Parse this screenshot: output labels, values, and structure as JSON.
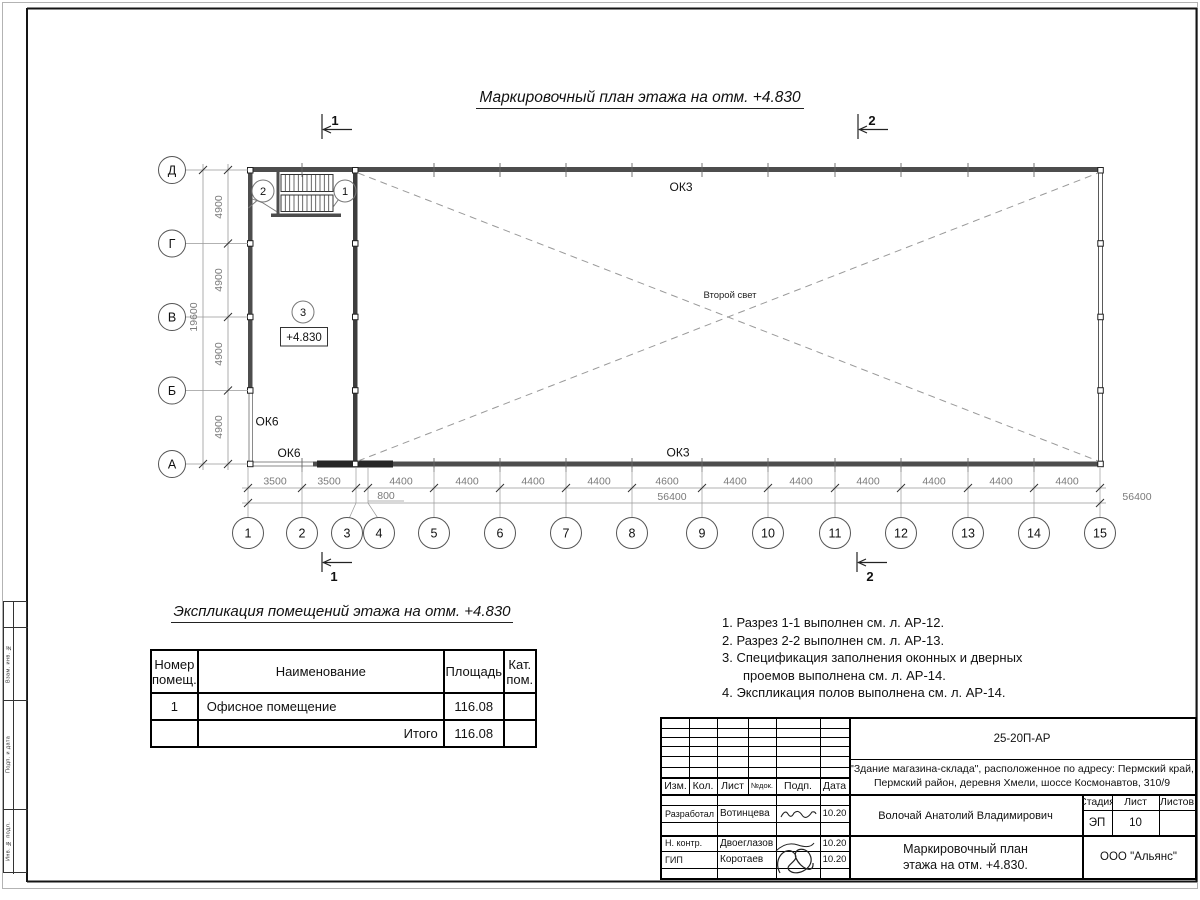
{
  "title": "Маркировочный план этажа на отм. +4.830",
  "plan": {
    "axes_h": [
      "1",
      "2",
      "3",
      "4",
      "5",
      "6",
      "7",
      "8",
      "9",
      "10",
      "11",
      "12",
      "13",
      "14",
      "15"
    ],
    "axes_v": [
      "Д",
      "Г",
      "В",
      "Б",
      "А"
    ],
    "dims_h": [
      "3500",
      "3500",
      "4400",
      "4400",
      "4400",
      "4400",
      "4600",
      "4400",
      "4400",
      "4400",
      "4400",
      "4400",
      "4400"
    ],
    "dim_small": "800",
    "dim_total_h": "56400",
    "dims_v": [
      "4900",
      "4900",
      "4900",
      "4900"
    ],
    "dim_total_v": "19600",
    "ok3": "ОК3",
    "ok6": "ОК6",
    "second_light": "Второй свет",
    "elevation": "+4.830",
    "markers": [
      "1",
      "2",
      "3"
    ],
    "sections": [
      "1",
      "2"
    ]
  },
  "explication": {
    "title": "Экспликация помещений этажа на отм. +4.830",
    "col_num_l1": "Номер",
    "col_num_l2": "помещ.",
    "col_name": "Наименование",
    "col_area": "Площадь",
    "col_cat_l1": "Кат.",
    "col_cat_l2": "пом.",
    "row1_num": "1",
    "row1_name": "Офисное помещение",
    "row1_area": "116.08",
    "total_label": "Итого",
    "total_value": "116.08"
  },
  "notes": {
    "lines": [
      "1. Разрез 1-1 выполнен см. л. АР-12.",
      "2. Разрез 2-2 выполнен см. л. АР-13.",
      "3. Спецификация заполнения оконных и дверных",
      "проемов выполнена см. л. АР-14.",
      "4. Экспликация полов выполнена см. л. АР-14."
    ]
  },
  "titleblock": {
    "doc_code": "25-20П-АР",
    "object_line1": "\"Здание магазина-склада\", расположенное по адресу: Пермский край,",
    "object_line2": "Пермский район, деревня Хмели, шоссе Космонавтов, 310/9",
    "cols": [
      "Изм.",
      "Кол.",
      "Лист",
      "№док.",
      "Подп.",
      "Дата"
    ],
    "row_developed_label": "Разработал",
    "row_developed_name": "Вотинцева",
    "row_ncontr_label": "Н. контр.",
    "row_ncontr_name": "Двоеглазов",
    "row_gip_label": "ГИП",
    "row_gip_name": "Коротаев",
    "date": "10.20",
    "chief_name": "Волочай Анатолий Владимирович",
    "stage_label": "Стадия",
    "sheet_label": "Лист",
    "sheets_label": "Листов",
    "stage": "ЭП",
    "sheet_num": "10",
    "drawing_title_l1": "Маркировочный план",
    "drawing_title_l2": "этажа на отм. +4.830.",
    "company": "ООО \"Альянс\""
  },
  "frame": {
    "margin_boxes": [
      "Взам. инв. №",
      "Подп. и дата",
      "Инв. № подл."
    ]
  }
}
